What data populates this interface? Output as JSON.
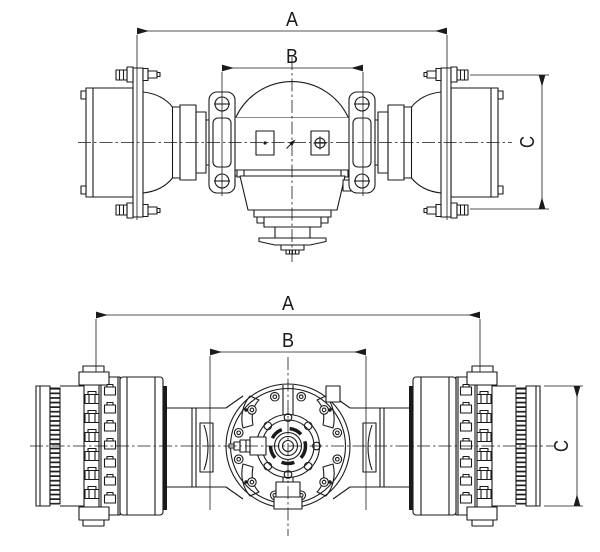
{
  "colors": {
    "background": "#ffffff",
    "line": "#1a1a1a"
  },
  "views": {
    "front": {
      "dim_a": "A",
      "dim_b": "B",
      "dim_c": "C"
    },
    "rear": {
      "dim_a": "A",
      "dim_b": "B",
      "dim_c": "C"
    }
  }
}
